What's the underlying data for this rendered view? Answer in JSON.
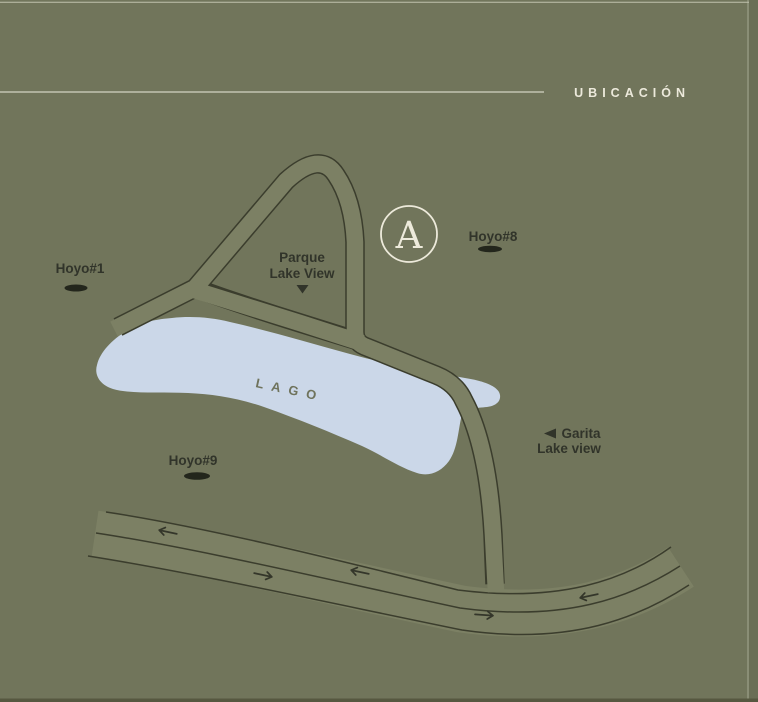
{
  "header": {
    "title": "UBICACIÓN"
  },
  "map": {
    "lake_label": "LAGO",
    "park": {
      "line1": "Parque",
      "line2": "Lake View"
    },
    "gate": {
      "line1": "Garita",
      "line2": "Lake view"
    },
    "marker_a": "A",
    "holes": [
      {
        "id": "hoyo-1",
        "label": "Hoyo#1"
      },
      {
        "id": "hoyo-8",
        "label": "Hoyo#8"
      },
      {
        "id": "hoyo-9",
        "label": "Hoyo#9"
      }
    ],
    "road_arrows": [
      "left",
      "right",
      "left",
      "right",
      "left"
    ]
  },
  "colors": {
    "background": "#71755B",
    "road_fill": "#7C8064",
    "road_casing": "#3B3D2D",
    "lake": "#CBD7E8",
    "label_dark": "#31342A",
    "cream": "#ECE9DB",
    "rule_line": "#D3D4C2"
  }
}
